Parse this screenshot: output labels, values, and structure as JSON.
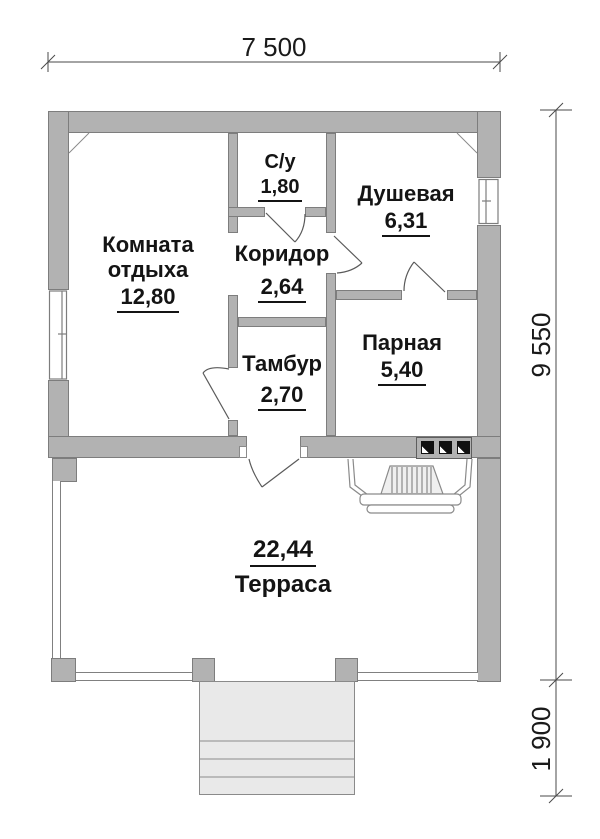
{
  "dimensions": {
    "width": "7 500",
    "height": "9 550",
    "stairs_depth": "1 900"
  },
  "rooms": {
    "rest": {
      "name": "Комната отдыха",
      "area": "12,80"
    },
    "wc": {
      "name": "С/у",
      "area": "1,80"
    },
    "shower": {
      "name": "Душевая",
      "area": "6,31"
    },
    "corridor": {
      "name": "Коридор",
      "area": "2,64"
    },
    "vestibule": {
      "name": "Тамбур",
      "area": "2,70"
    },
    "steam": {
      "name": "Парная",
      "area": "5,40"
    },
    "terrace": {
      "name": "Терраса",
      "area": "22,44"
    }
  },
  "colors": {
    "wall_fill": "#b2b2b2",
    "wall_outline": "#7d7d7d",
    "line": "#5a5a5a",
    "dimension_line": "#4a4a4a",
    "stairs_fill": "#e9e9e9",
    "text": "#141414"
  }
}
